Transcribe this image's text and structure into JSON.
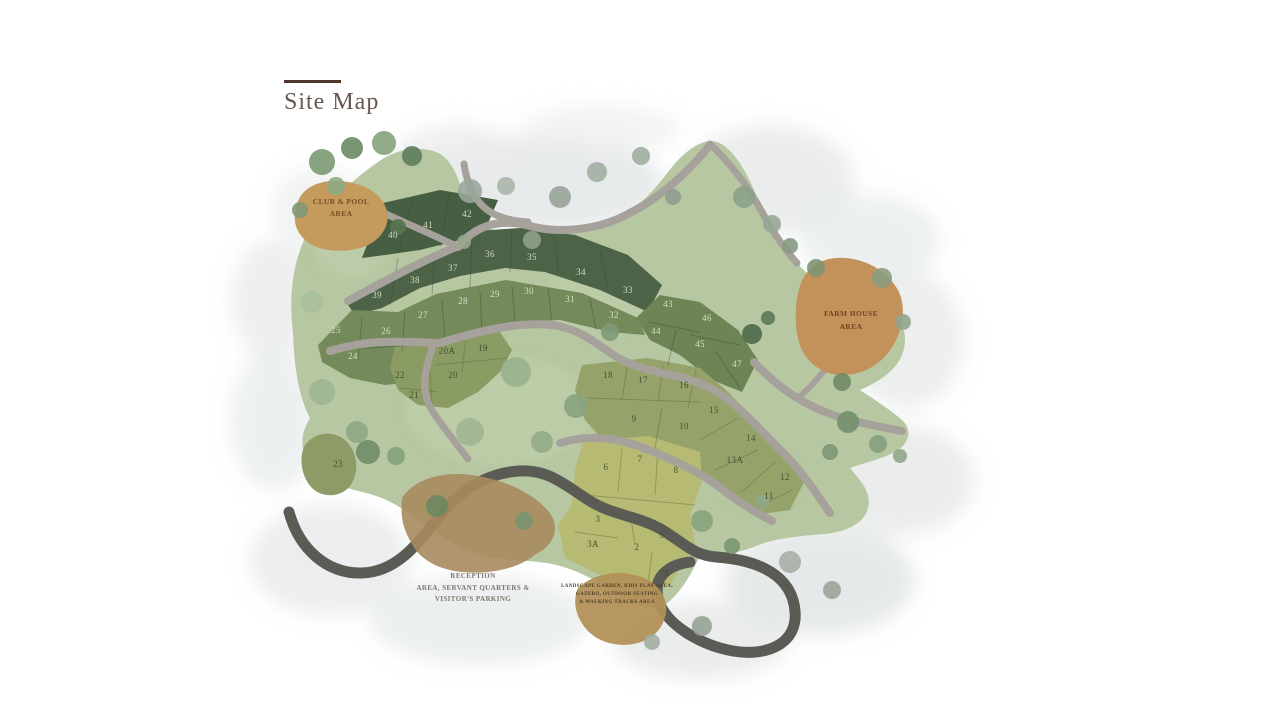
{
  "page": {
    "title": "Site Map"
  },
  "map": {
    "areas": {
      "club_pool": {
        "line1": "CLUB & POOL",
        "line2": "AREA"
      },
      "farm_house": {
        "line1": "FARM HOUSE",
        "line2": "AREA"
      },
      "reception": {
        "line1": "RECEPTION",
        "line2": "AREA, SERVANT QUARTERS &",
        "line3": "VISITOR'S PARKING"
      },
      "amenities": {
        "line1": "LANDSCAPE GARDEN, KIDS PLAY AREA,",
        "line2": "GAZEBO, OUTDOOR SEATING",
        "line3": "& WALKING TRACKS AREA"
      }
    },
    "plots": [
      {
        "n": "1",
        "x": 667,
        "y": 576,
        "tone": "dark"
      },
      {
        "n": "2",
        "x": 637,
        "y": 550,
        "tone": "dark"
      },
      {
        "n": "3",
        "x": 598,
        "y": 522,
        "tone": "dark"
      },
      {
        "n": "3A",
        "x": 593,
        "y": 547,
        "tone": "dark"
      },
      {
        "n": "5",
        "x": 662,
        "y": 538,
        "tone": "dark"
      },
      {
        "n": "6",
        "x": 606,
        "y": 470,
        "tone": "dark"
      },
      {
        "n": "7",
        "x": 640,
        "y": 462,
        "tone": "dark"
      },
      {
        "n": "8",
        "x": 676,
        "y": 473,
        "tone": "dark"
      },
      {
        "n": "9",
        "x": 634,
        "y": 422,
        "tone": "dark"
      },
      {
        "n": "10",
        "x": 684,
        "y": 429,
        "tone": "dark"
      },
      {
        "n": "11",
        "x": 769,
        "y": 499,
        "tone": "dark"
      },
      {
        "n": "12",
        "x": 785,
        "y": 480,
        "tone": "dark"
      },
      {
        "n": "13A",
        "x": 735,
        "y": 463,
        "tone": "dark"
      },
      {
        "n": "14",
        "x": 751,
        "y": 441,
        "tone": "dark"
      },
      {
        "n": "15",
        "x": 714,
        "y": 413,
        "tone": "dark"
      },
      {
        "n": "16",
        "x": 684,
        "y": 388,
        "tone": "dark"
      },
      {
        "n": "17",
        "x": 643,
        "y": 383,
        "tone": "dark"
      },
      {
        "n": "18",
        "x": 608,
        "y": 378,
        "tone": "dark"
      },
      {
        "n": "19",
        "x": 483,
        "y": 351,
        "tone": "dark"
      },
      {
        "n": "20",
        "x": 453,
        "y": 378,
        "tone": "dark"
      },
      {
        "n": "20A",
        "x": 447,
        "y": 354,
        "tone": "dark"
      },
      {
        "n": "21",
        "x": 414,
        "y": 398,
        "tone": "dark"
      },
      {
        "n": "22",
        "x": 400,
        "y": 378,
        "tone": "dark"
      },
      {
        "n": "23",
        "x": 338,
        "y": 467,
        "tone": "dark"
      },
      {
        "n": "24",
        "x": 353,
        "y": 359,
        "tone": "light"
      },
      {
        "n": "25",
        "x": 336,
        "y": 333,
        "tone": "light"
      },
      {
        "n": "26",
        "x": 386,
        "y": 334,
        "tone": "light"
      },
      {
        "n": "27",
        "x": 423,
        "y": 318,
        "tone": "light"
      },
      {
        "n": "28",
        "x": 463,
        "y": 304,
        "tone": "light"
      },
      {
        "n": "29",
        "x": 495,
        "y": 297,
        "tone": "light"
      },
      {
        "n": "30",
        "x": 529,
        "y": 294,
        "tone": "light"
      },
      {
        "n": "31",
        "x": 570,
        "y": 302,
        "tone": "light"
      },
      {
        "n": "32",
        "x": 614,
        "y": 318,
        "tone": "light"
      },
      {
        "n": "33",
        "x": 628,
        "y": 293,
        "tone": "light"
      },
      {
        "n": "34",
        "x": 581,
        "y": 275,
        "tone": "light"
      },
      {
        "n": "35",
        "x": 532,
        "y": 260,
        "tone": "light"
      },
      {
        "n": "36",
        "x": 490,
        "y": 257,
        "tone": "light"
      },
      {
        "n": "37",
        "x": 453,
        "y": 271,
        "tone": "light"
      },
      {
        "n": "38",
        "x": 415,
        "y": 283,
        "tone": "light"
      },
      {
        "n": "39",
        "x": 377,
        "y": 298,
        "tone": "light"
      },
      {
        "n": "40",
        "x": 393,
        "y": 238,
        "tone": "light"
      },
      {
        "n": "41",
        "x": 428,
        "y": 228,
        "tone": "light"
      },
      {
        "n": "42",
        "x": 467,
        "y": 217,
        "tone": "light"
      },
      {
        "n": "43",
        "x": 668,
        "y": 307,
        "tone": "light"
      },
      {
        "n": "44",
        "x": 656,
        "y": 334,
        "tone": "light"
      },
      {
        "n": "45",
        "x": 700,
        "y": 347,
        "tone": "light"
      },
      {
        "n": "46",
        "x": 707,
        "y": 321,
        "tone": "light"
      },
      {
        "n": "47",
        "x": 737,
        "y": 367,
        "tone": "light"
      }
    ],
    "palette": {
      "accent_rule": "#4e382e",
      "title_text": "#675850",
      "site_green": "#b6c7a2",
      "dark_plot": "#4c6347",
      "medium_plot": "#748a5a",
      "olive_plot": "#95a36b",
      "yellow_plot": "#b6ba72",
      "road": "#a6a29b",
      "entry_road": "#595b54",
      "club_tan": "#c59a5d",
      "farm_tan": "#c2925a",
      "reception_tan": "#a9895e"
    }
  }
}
